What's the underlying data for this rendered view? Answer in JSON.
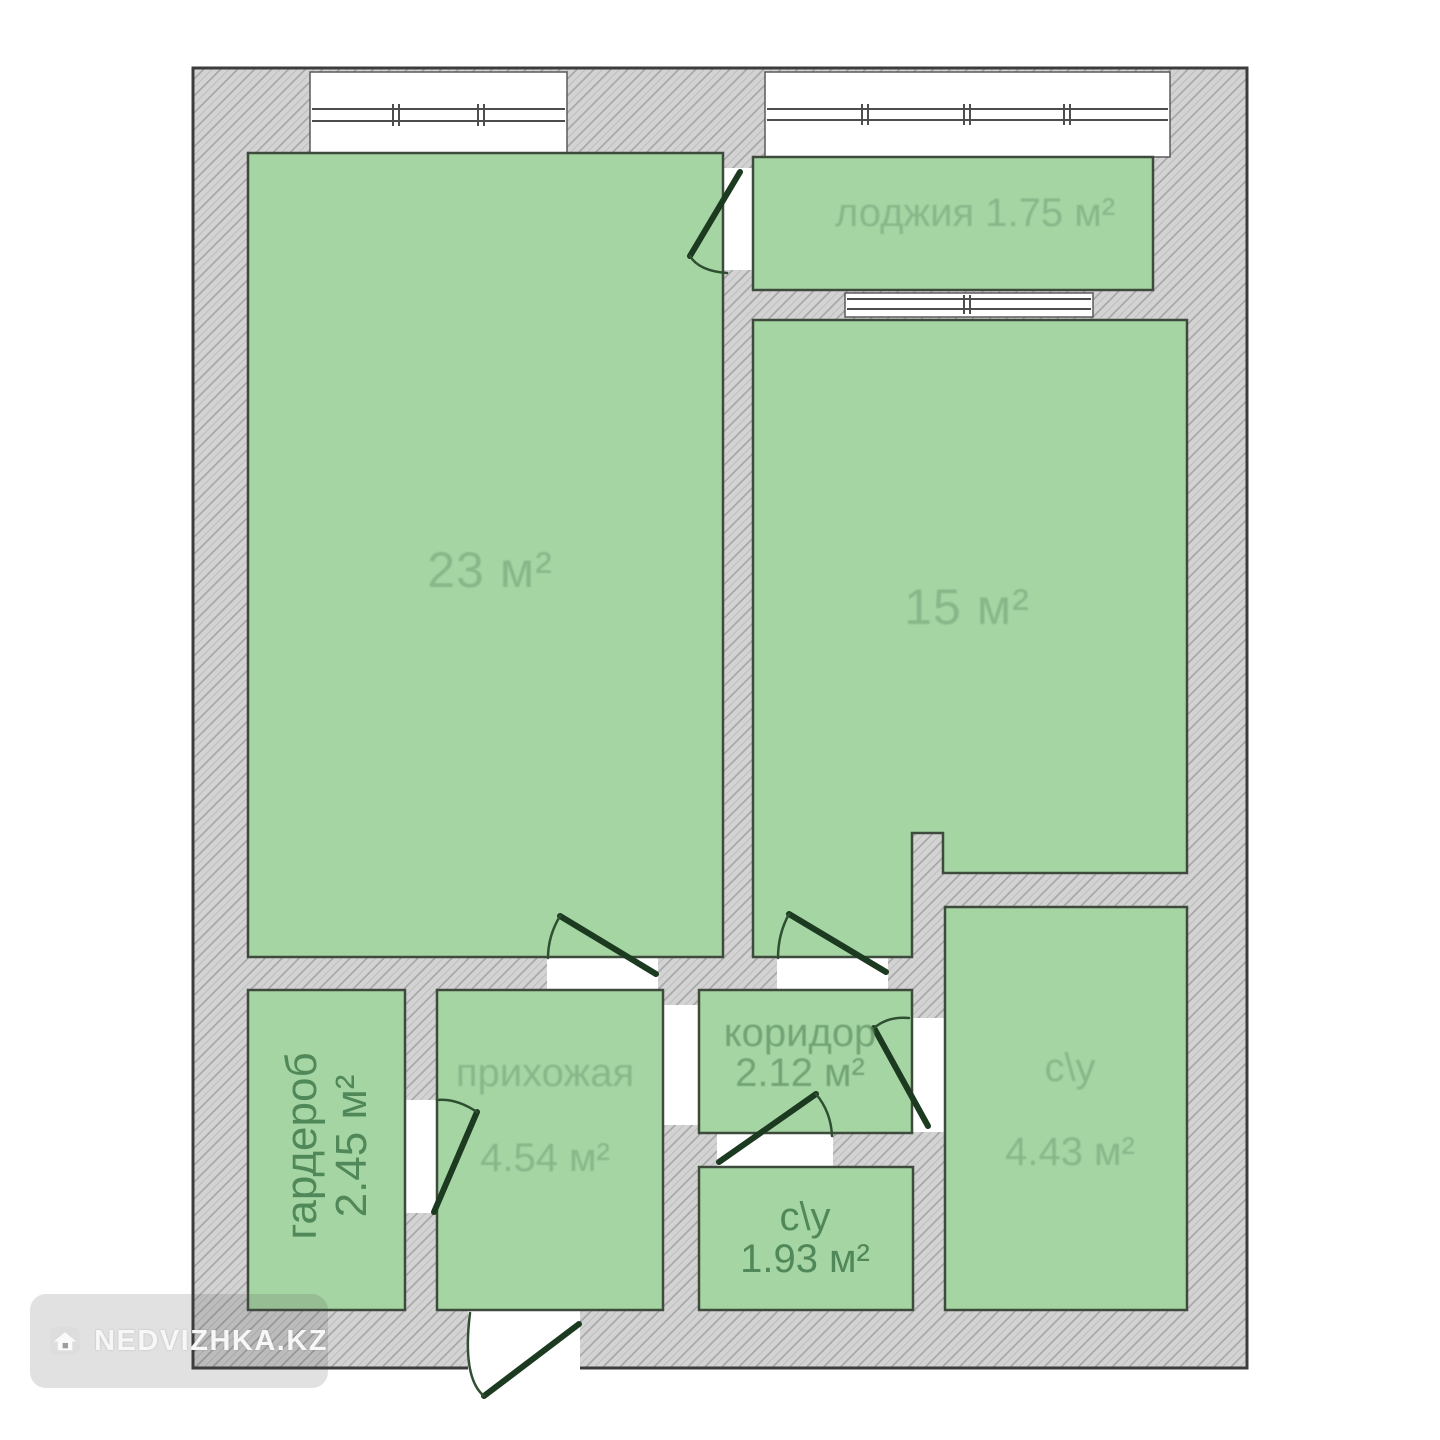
{
  "plan": {
    "rooms": {
      "living": {
        "area": "23 м²"
      },
      "bedroom": {
        "area": "15 м²"
      },
      "loggia": {
        "name": "лоджия",
        "area": "1.75 м²"
      },
      "wardrobe": {
        "name": "гардероб",
        "area": "2.45 м²"
      },
      "hallway": {
        "name": "прихожая",
        "area": "4.54 м²"
      },
      "corridor": {
        "name": "коридор",
        "area": "2.12 м²"
      },
      "bathroom_small": {
        "name": "с\\у",
        "area": "1.93 м²"
      },
      "bathroom_large": {
        "name": "с\\у",
        "area": "4.43 м²"
      }
    },
    "colors": {
      "room_fill": "#a6d5a4",
      "room_outline": "#3e4b3c",
      "wall_fill": "#d3d3d3",
      "wall_hatch_line": "#a4a4a4",
      "outer_outline": "#3c3c3c",
      "door_leaf": "#1c3a20",
      "label_strong": "#4c8456",
      "label_muted": "#6f9f74"
    }
  },
  "watermark": {
    "text": "NEDVIZHKA.KZ",
    "icon": "house-icon"
  }
}
